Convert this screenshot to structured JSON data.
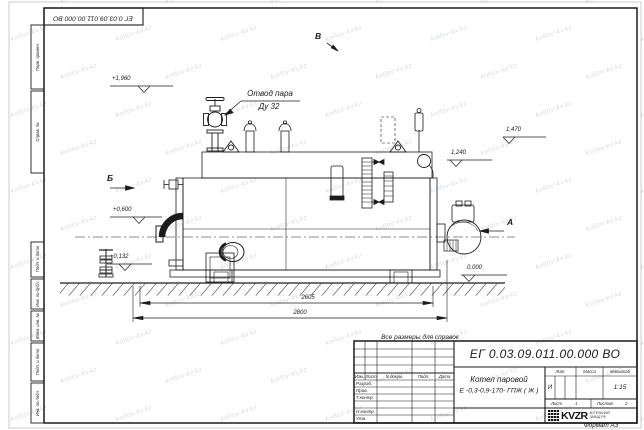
{
  "page": {
    "format_label": "Формат А3",
    "reference_note": "Все размеры для справок"
  },
  "top_stamp": {
    "doc_number": "ЕГ 0.03.09.011.00.000  ВО"
  },
  "margin_columns": {
    "top": [
      {
        "label": "Перв. примен."
      },
      {
        "label": "Справ. №"
      }
    ],
    "bottom": [
      {
        "label": "Подп. и дата"
      },
      {
        "label": "Инв. № дубл."
      },
      {
        "label": "Взам. инв. №"
      },
      {
        "label": "Подп. и дата"
      },
      {
        "label": "Инв. № подл."
      }
    ]
  },
  "title_block": {
    "doc_number": "ЕГ 0.03.09.011.00.000  ВО",
    "product_name_line1": "Котел паровой",
    "product_name_line2": "Е -0,3-0,9-170- ГПЖ ( Ж )",
    "change_table_headers": [
      "Изм.",
      "Лист",
      "N докум.",
      "Подп.",
      "Дата"
    ],
    "signature_rows": [
      "Разраб.",
      "Пров.",
      "Т.контр.",
      "Н.контр.",
      "Утв."
    ],
    "lit_header": "Лит.",
    "mass_header": "Масса",
    "scale_header": "Масштаб",
    "lit_value": "И",
    "scale_value": "1:15",
    "sheet_label": "Лист",
    "sheet_number": "1",
    "sheets_label": "Листов",
    "sheets_total": "2",
    "logo_text": "KVZR",
    "logo_caption_line1": "КОТЕЛЬНЫЙ",
    "logo_caption_line2": "ЗАВОД РФ"
  },
  "annotations": {
    "steam_outlet_label": "Отвод пара",
    "steam_outlet_size": "Ду 32",
    "level_marks": [
      "+1,960",
      "+0,600",
      "+0,132",
      "1,470",
      "1,240",
      "0,000"
    ],
    "view_labels": [
      "В",
      "Б",
      "А"
    ],
    "dimensions": [
      "2605",
      "2800"
    ]
  },
  "watermark": {
    "text": "kotlov-kv.kz"
  }
}
